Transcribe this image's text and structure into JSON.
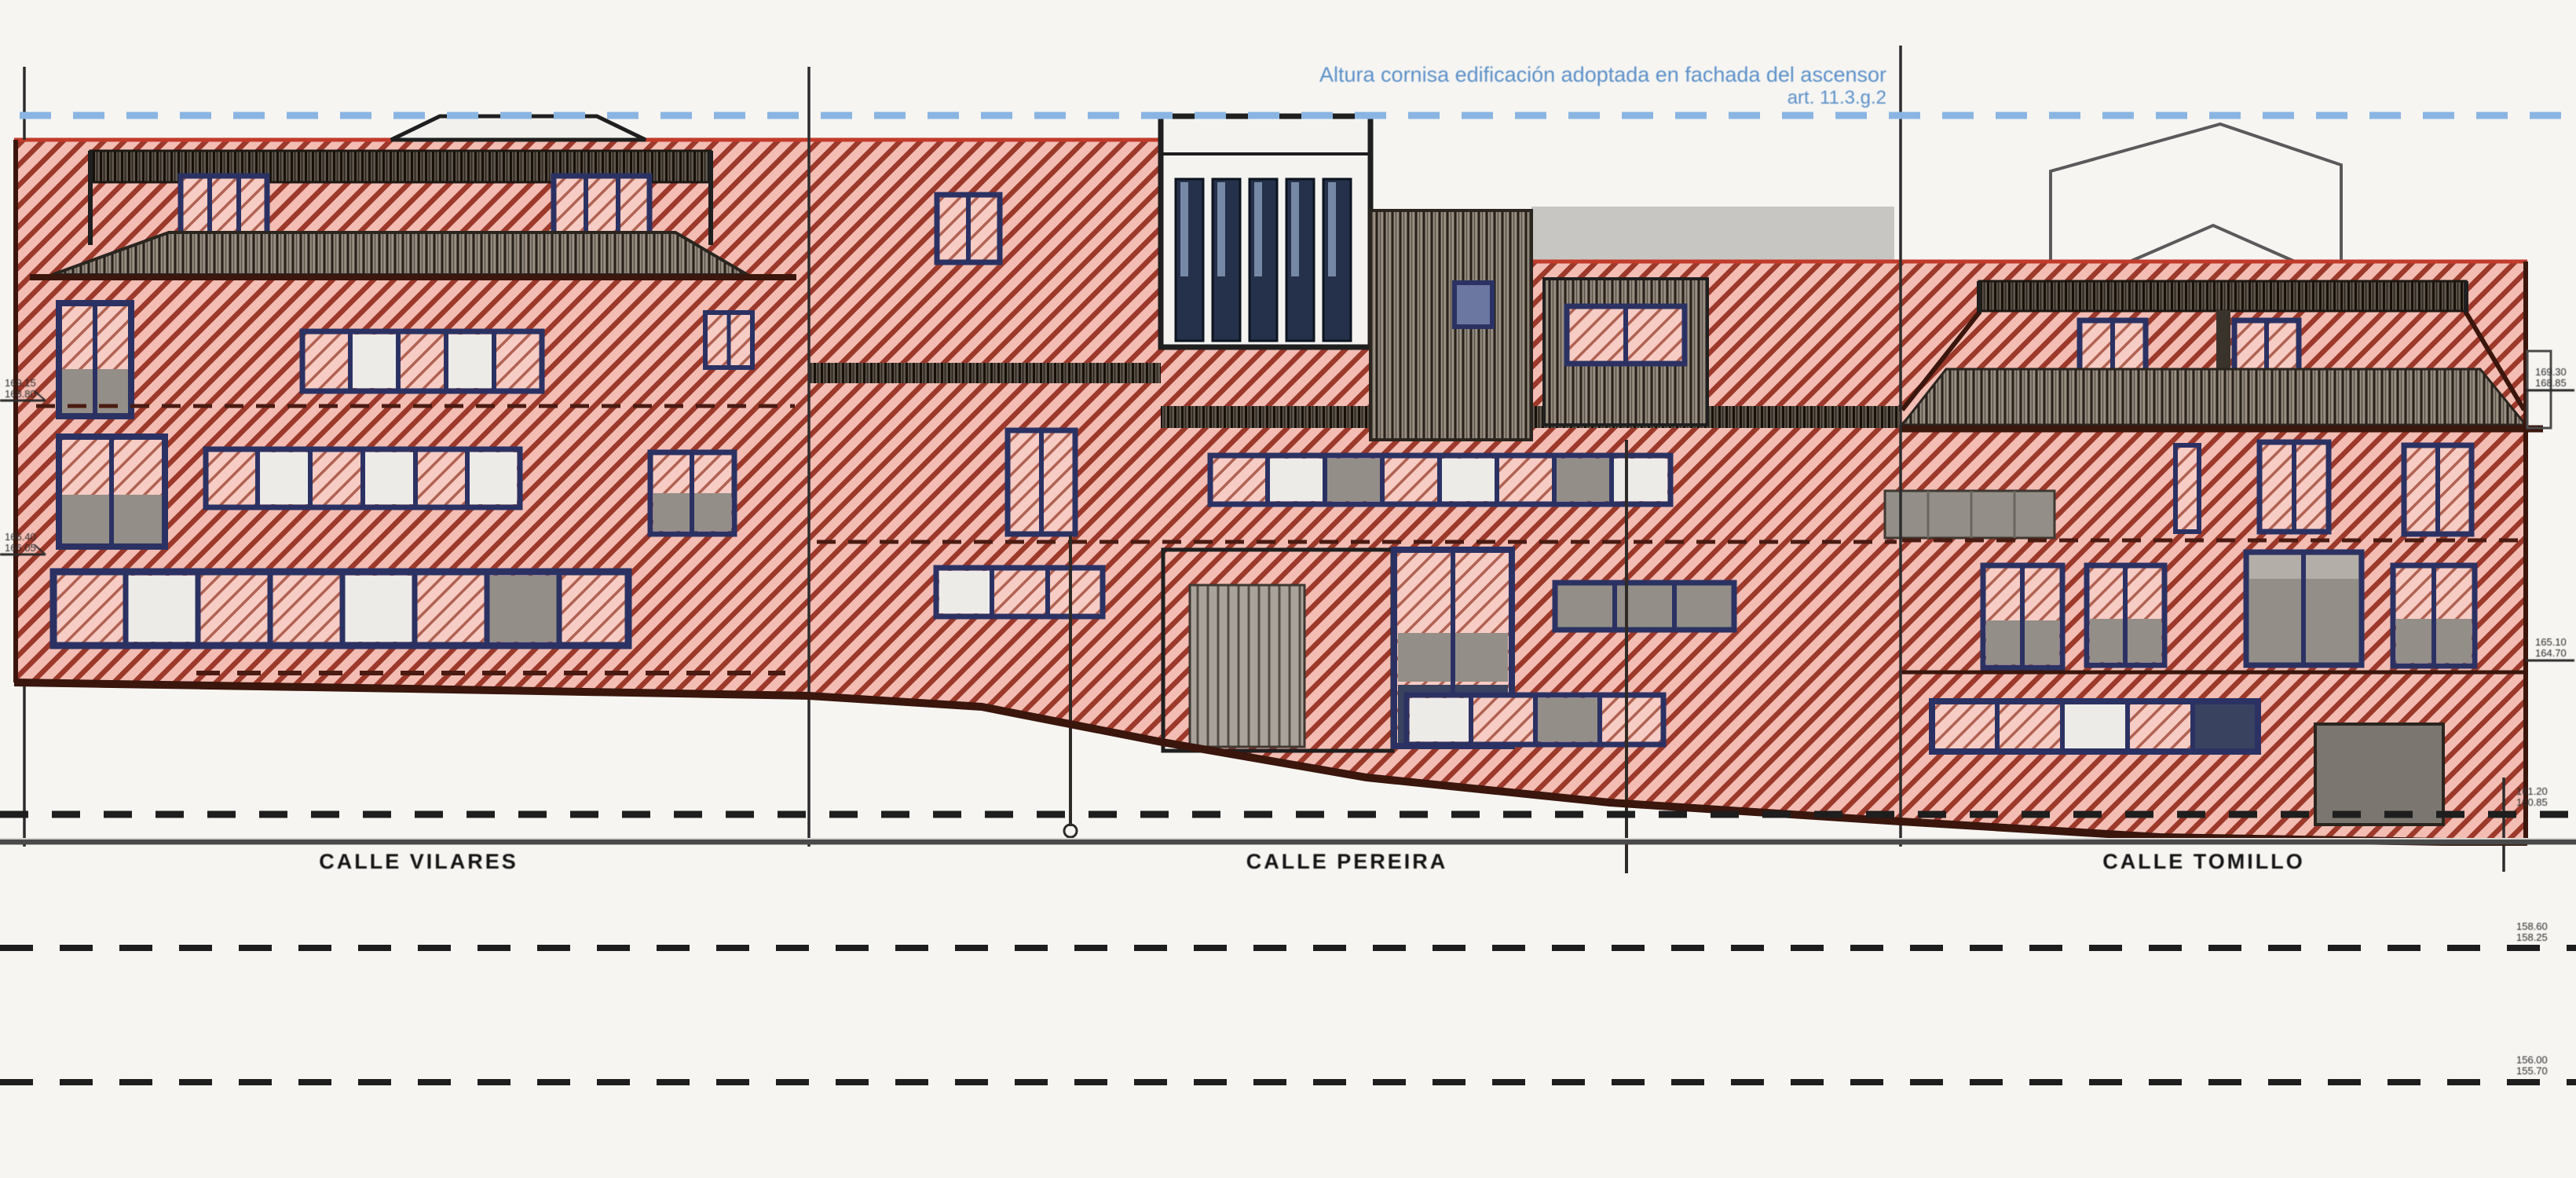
{
  "colors": {
    "paper": "#f6f5f2",
    "hatch_bg": "#f3bdb4",
    "hatch_line": "#9c392b",
    "hatch_bg_light": "#f6ccc4",
    "hatch_line_light": "#b06252",
    "frame_blue": "#2b3263",
    "pane_gray": "#938e87",
    "roof_bg": "#998f83",
    "roof_line": "#29221b",
    "roof_dark_bg": "#60584e",
    "roof_dark_line": "#161009",
    "door_bg": "#a8a29a",
    "door_line": "#544d45",
    "gray_block": "#c8c6c2",
    "garage_gray": "#7b766f",
    "guide_blue": "#8ab5e2",
    "note_blue": "#5b90c9",
    "ink": "#1f1f1f",
    "dark_edge": "#3a160d",
    "red_edge": "#c23b2b",
    "dash_dark": "#4a1b12"
  },
  "note": {
    "line1": "Altura cornisa edificación adoptada en fachada del ascensor",
    "line2": "art. 11.3.g.2"
  },
  "streets": [
    {
      "label": "CALLE VILARES"
    },
    {
      "label": "CALLE PEREIRA"
    },
    {
      "label": "CALLE TOMILLO"
    }
  ],
  "markers": {
    "facade_left": [
      {
        "l1": "169.15",
        "l2": "168.80"
      },
      {
        "l1": "166.40",
        "l2": "166.05"
      }
    ],
    "facade_right": [
      {
        "l1": "169.30",
        "l2": "168.85"
      },
      {
        "l1": "165.10",
        "l2": "164.70"
      }
    ],
    "datum_right": [
      {
        "l1": "161.20",
        "l2": "160.85"
      },
      {
        "l1": "158.60",
        "l2": "158.25"
      },
      {
        "l1": "156.00",
        "l2": "155.70"
      }
    ]
  }
}
